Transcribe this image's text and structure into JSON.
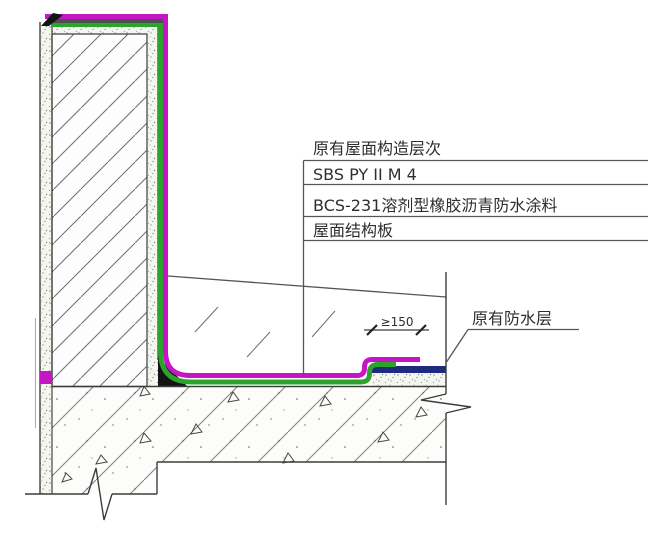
{
  "drawing_type": "roof-parapet-waterproofing-detail",
  "callout": {
    "title": "原有屋面构造层次",
    "layers": [
      "SBS PY II M 4",
      "BCS-231溶剂型橡胶沥青防水涂料",
      "屋面结构板"
    ]
  },
  "labels": {
    "existing_waterproofing": "原有防水层"
  },
  "dimension": {
    "lap_length": "≥150"
  },
  "colors": {
    "new_membrane_magenta": "#c516c5",
    "coating_green": "#2ca32c",
    "existing_waterproof_blue": "#1e2b7d",
    "capping_dark": "#4f4f4f",
    "sealant_black": "#141414",
    "line_gray": "#3d3d3d"
  }
}
